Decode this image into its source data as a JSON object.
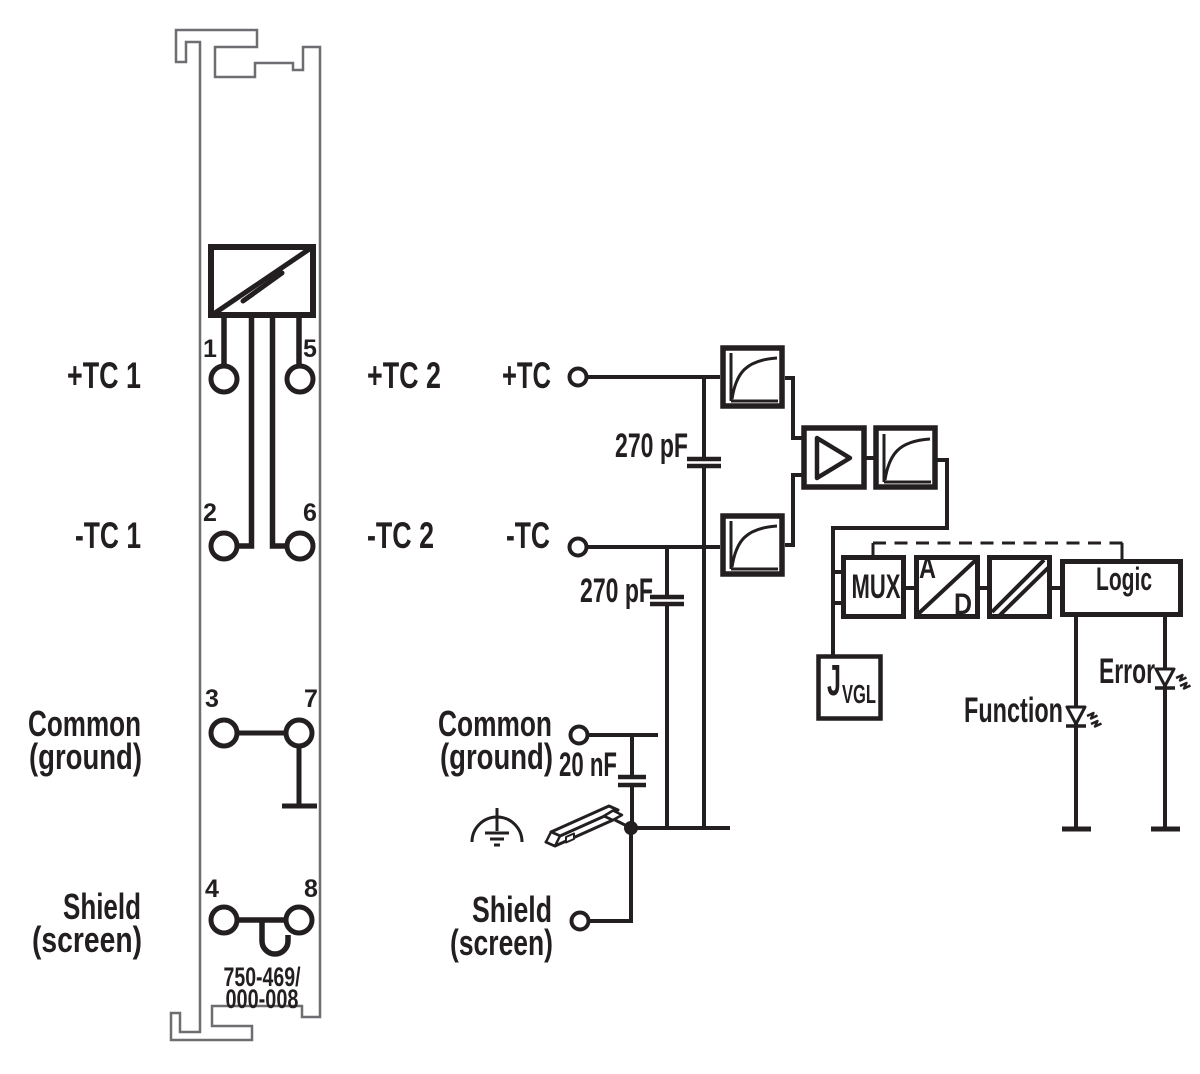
{
  "colors": {
    "ink": "#231f20",
    "module_outline": "#6d6e71",
    "background": "#ffffff"
  },
  "module": {
    "labels": {
      "tc1_plus": "+TC 1",
      "tc1_minus": "-TC 1",
      "tc2_plus": "+TC 2",
      "tc2_minus": "-TC 2",
      "common_line1": "Common",
      "common_line2": "(ground)",
      "shield_line1": "Shield",
      "shield_line2": "(screen)"
    },
    "pin_numbers": {
      "p1": "1",
      "p2": "2",
      "p3": "3",
      "p4": "4",
      "p5": "5",
      "p6": "6",
      "p7": "7",
      "p8": "8"
    },
    "part_number_line1": "750-469/",
    "part_number_line2": "000-008"
  },
  "circuit": {
    "terminals": {
      "tc_plus": "+TC",
      "tc_minus": "-TC",
      "common_line1": "Common",
      "common_line2": "(ground)",
      "shield_line1": "Shield",
      "shield_line2": "(screen)"
    },
    "capacitors": {
      "c1": "270 pF",
      "c2": "270 pF",
      "c3": "20 nF"
    },
    "blocks": {
      "mux": "MUX",
      "adc_a": "A",
      "adc_d": "D",
      "logic": "Logic",
      "jvgl_main": "J",
      "jvgl_sub": "VGL"
    },
    "leds": {
      "function": "Function",
      "error": "Error"
    }
  }
}
